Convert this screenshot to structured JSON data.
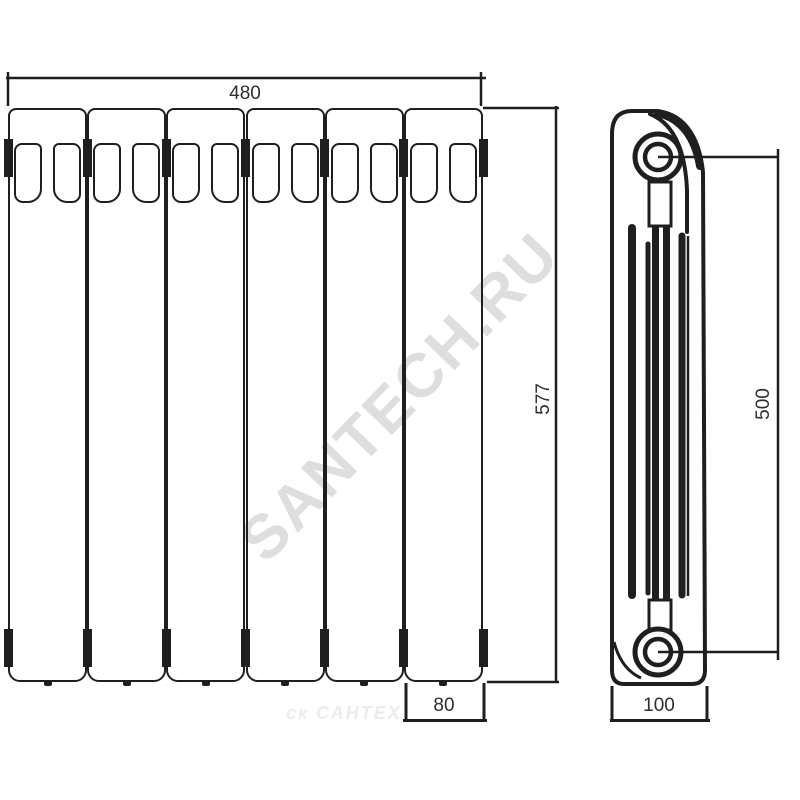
{
  "dimensions": {
    "total_width": "480",
    "total_height": "577",
    "section_width": "80",
    "section_depth": "100",
    "axis_spacing": "500"
  },
  "front_view": {
    "sections_count": 6
  },
  "watermark": {
    "text": "SANTECH.RU"
  },
  "watermark_small": {
    "text": "ск САНТЕХ"
  },
  "colors": {
    "line": "#1f1f1f",
    "dim_text": "#2e2e2e",
    "watermark": "#dedede",
    "watermark_small": "#ececec",
    "background": "#ffffff"
  }
}
